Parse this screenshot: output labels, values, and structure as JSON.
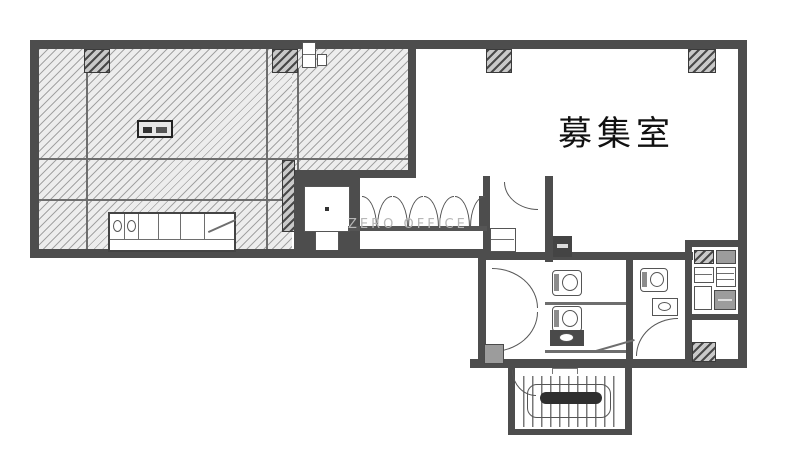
{
  "plan": {
    "room_label": "募集室",
    "watermark": "ZERO OFFICE"
  },
  "colors": {
    "wall": "#4d4d4d",
    "hatch_background": "#ededed",
    "hatch_line": "#5a5a5a",
    "detail_line": "#555555",
    "label_text": "#111111",
    "watermark_text": "#b7b7b7",
    "paper": "#ffffff"
  },
  "features": {
    "hatched_area": "existing-tenant-area",
    "vacant_area": "vacant-office-room",
    "elevator": "elevator",
    "stairs": "staircase",
    "restrooms": "toilet-block",
    "kitchenette": "kitchenette-unit"
  }
}
